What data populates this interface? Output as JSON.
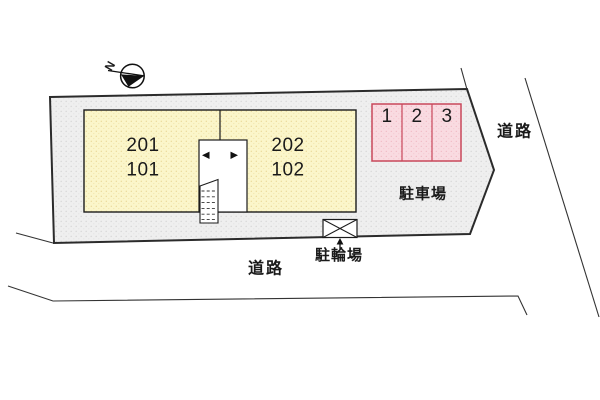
{
  "diagram": {
    "type": "site-plan",
    "north_label": "N",
    "building": {
      "units": [
        {
          "upper": "201",
          "lower": "101"
        },
        {
          "upper": "202",
          "lower": "102"
        }
      ]
    },
    "parking": {
      "label": "駐車場",
      "stalls": [
        "1",
        "2",
        "3"
      ]
    },
    "bicycle_parking": {
      "label": "駐輪場"
    },
    "roads": {
      "right": "道路",
      "bottom": "道路"
    },
    "colors": {
      "plot_fill": "#efefef",
      "plot_dot": "#d8d8d8",
      "building_fill": "#fbf6ca",
      "building_dot": "#e9d795",
      "parking_fill": "#f9dbe1",
      "parking_dot": "#f0b7c2",
      "parking_border": "#c9485b",
      "line": "#2b2b2b"
    }
  }
}
